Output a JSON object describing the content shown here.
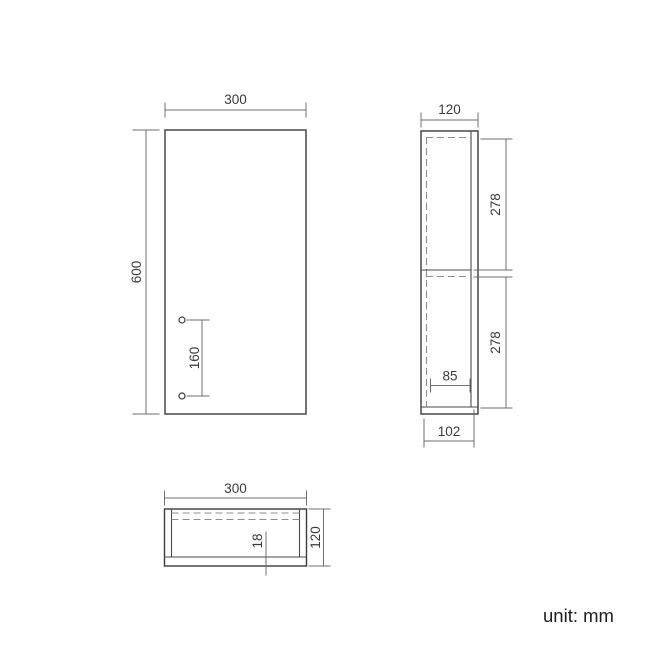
{
  "page": {
    "unit_label": "unit: mm",
    "background": "#ffffff"
  },
  "colors": {
    "object_line": "#3a3a3a",
    "dimension_line": "#6f6f6f",
    "hidden_line": "#8c8c8c",
    "text": "#3a3a3a"
  },
  "views": {
    "front": {
      "width_mm": "300",
      "height_mm": "600",
      "hole_spacing_mm": "160"
    },
    "side": {
      "depth_mm": "120",
      "upper_section_mm": "278",
      "lower_section_mm": "278",
      "shelf_clearance_mm": "85",
      "inner_depth_mm": "102"
    },
    "bottom": {
      "width_mm": "300",
      "depth_mm": "120",
      "panel_thickness_mm": "18"
    }
  }
}
